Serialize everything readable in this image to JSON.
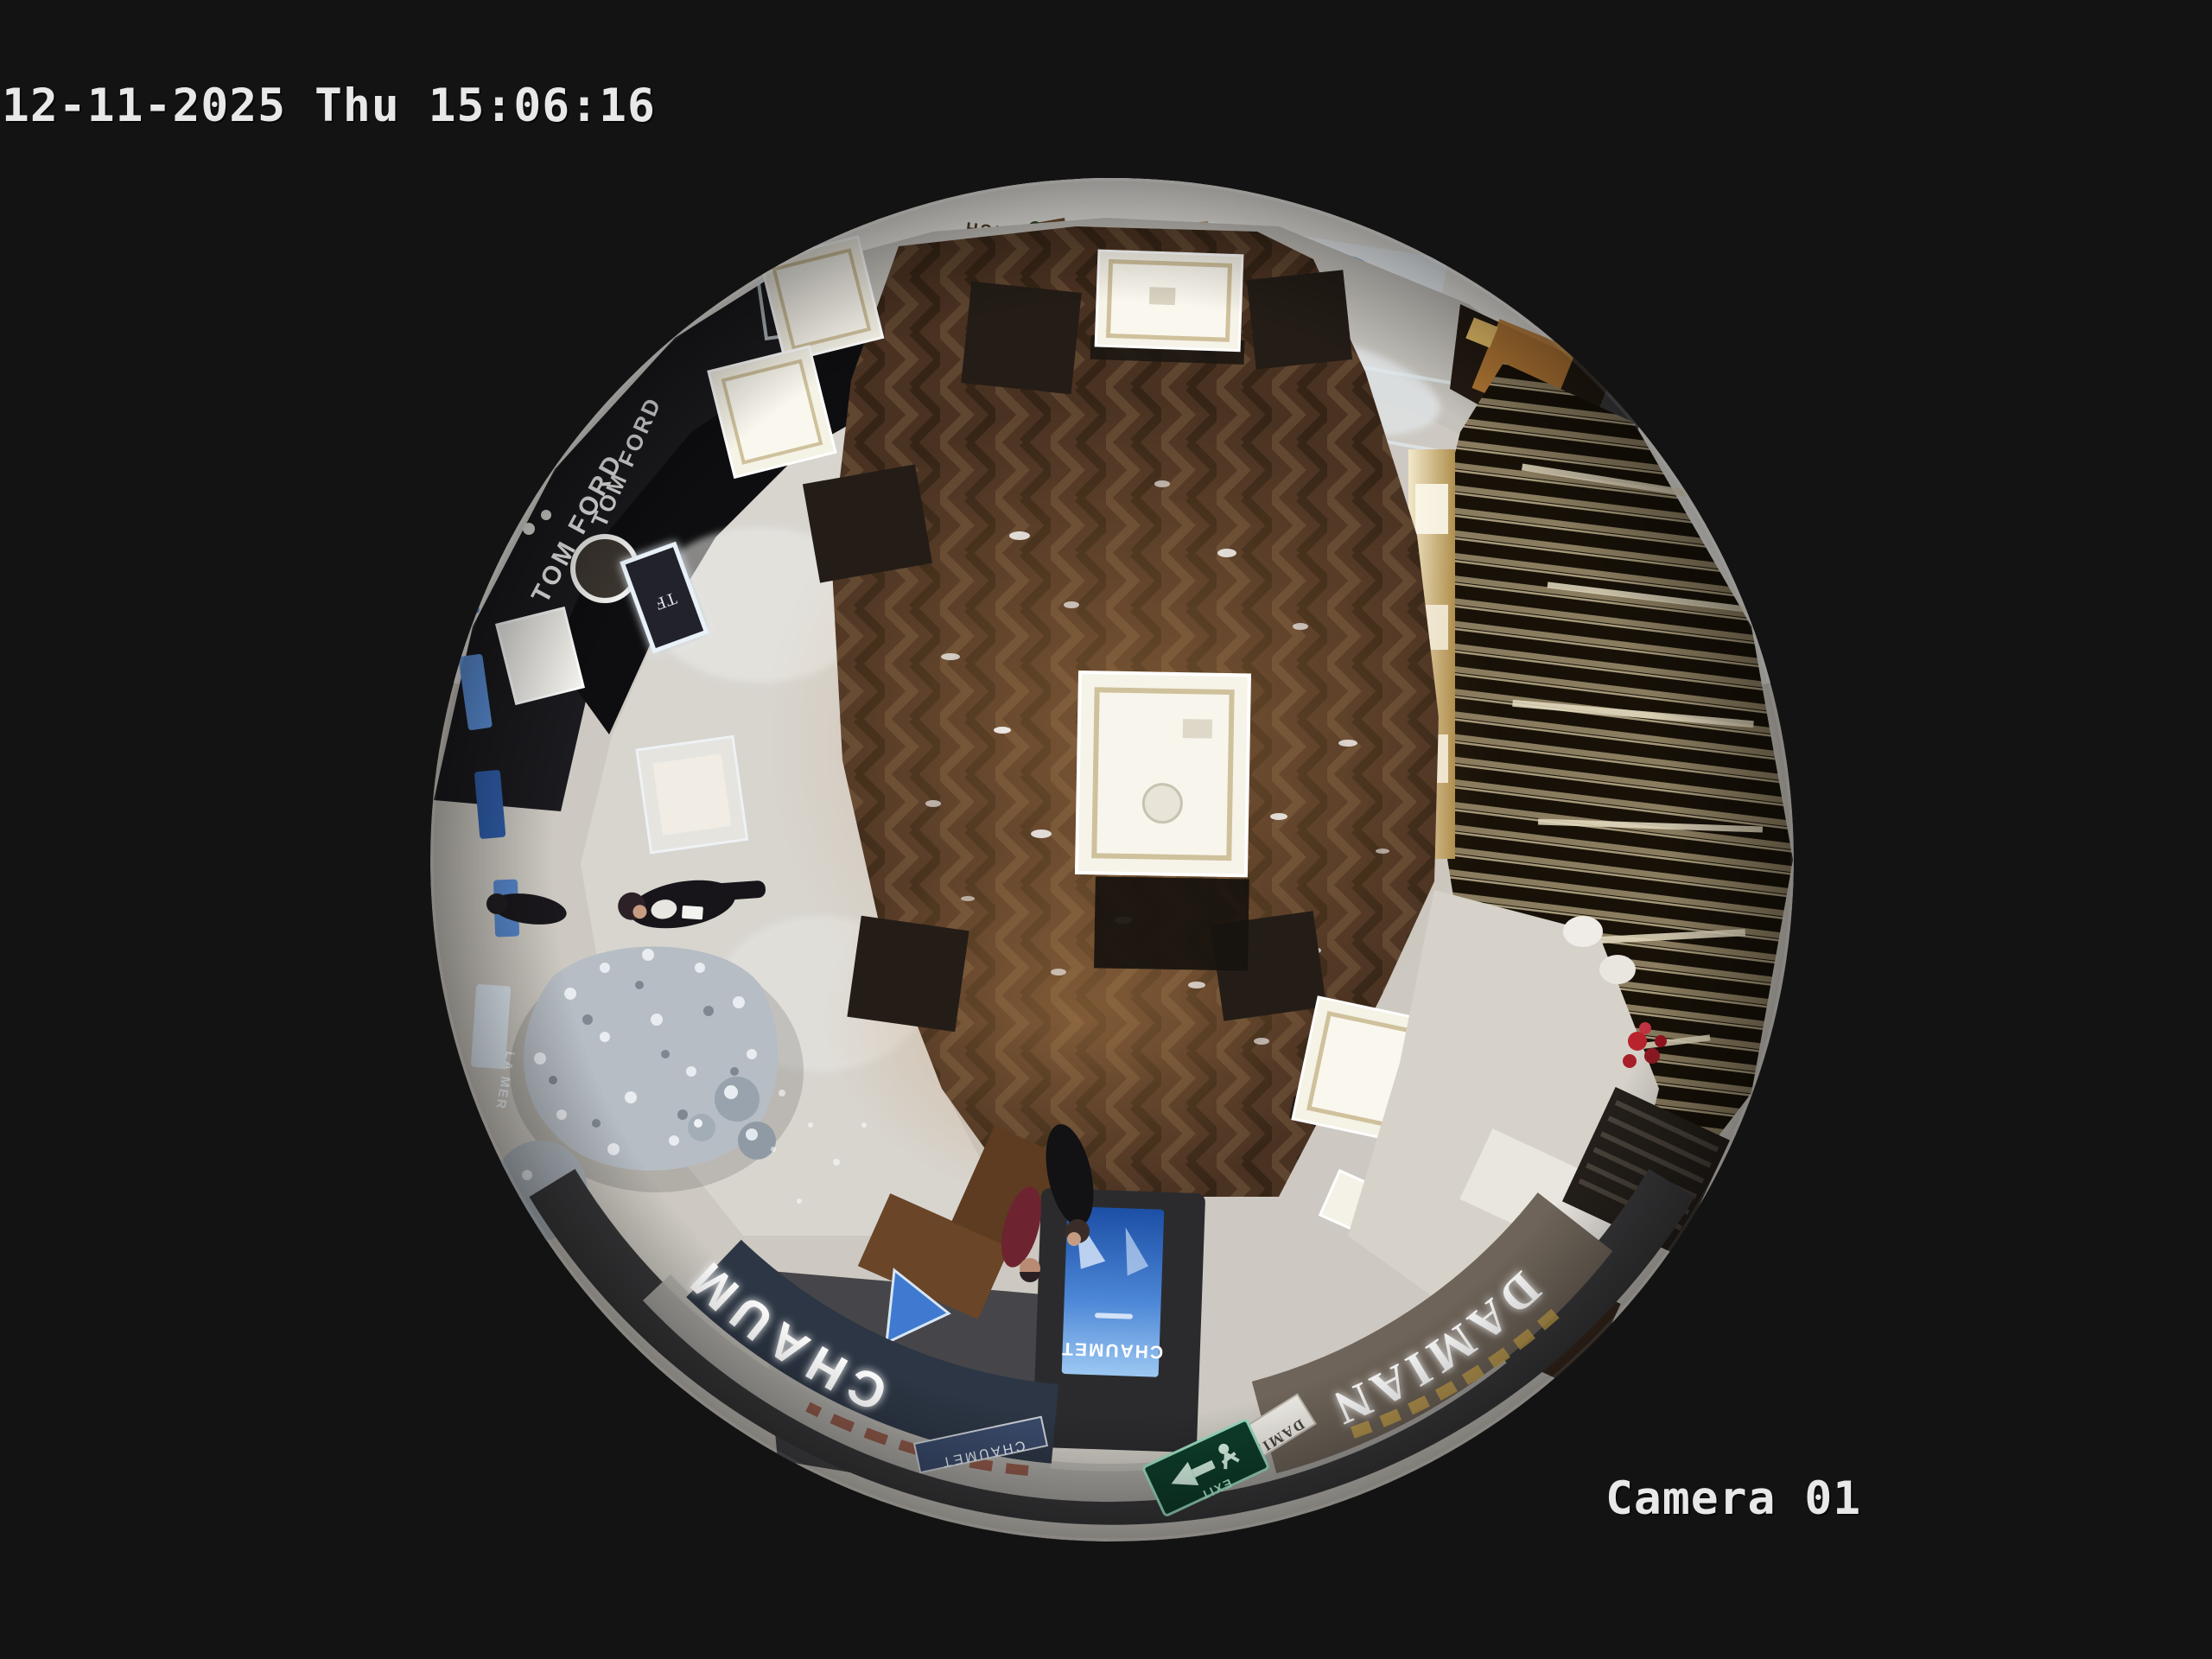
{
  "osd": {
    "timestamp": "12-11-2025 Thu 15:06:16",
    "camera_label": "Camera 01"
  },
  "scene": {
    "storefront_signs": {
      "tom_ford": "TOM FORD",
      "chaumet": "CHAUMET",
      "damiani": "DAMIANI",
      "korich": "KORICH",
      "la_mer": "LA MER"
    },
    "small_signs": {
      "tf_monogram": "TF",
      "chaumet_plaque": "CHAUMET",
      "damiani_plaque": "DAMIANI",
      "kiosk_screen_brand": "CHAUMET",
      "exit_label": "EXIT"
    },
    "colors": {
      "background": "#131313",
      "osd_text": "#e8e8e8",
      "wood_floor": "#4a3222",
      "stone_floor": "#cdc9c2",
      "tomford_fascia": "#0e0e10",
      "chaumet_fascia": "#2c3644",
      "damiani_fascia": "#6e6459",
      "gold_wall": "#ad9468",
      "kiosk_screen_blue": "#2a62b8",
      "exit_sign_green": "#0e3d2a",
      "vitrine_light": "#f6f3e8",
      "tree_silver": "#b6bdc4"
    }
  }
}
